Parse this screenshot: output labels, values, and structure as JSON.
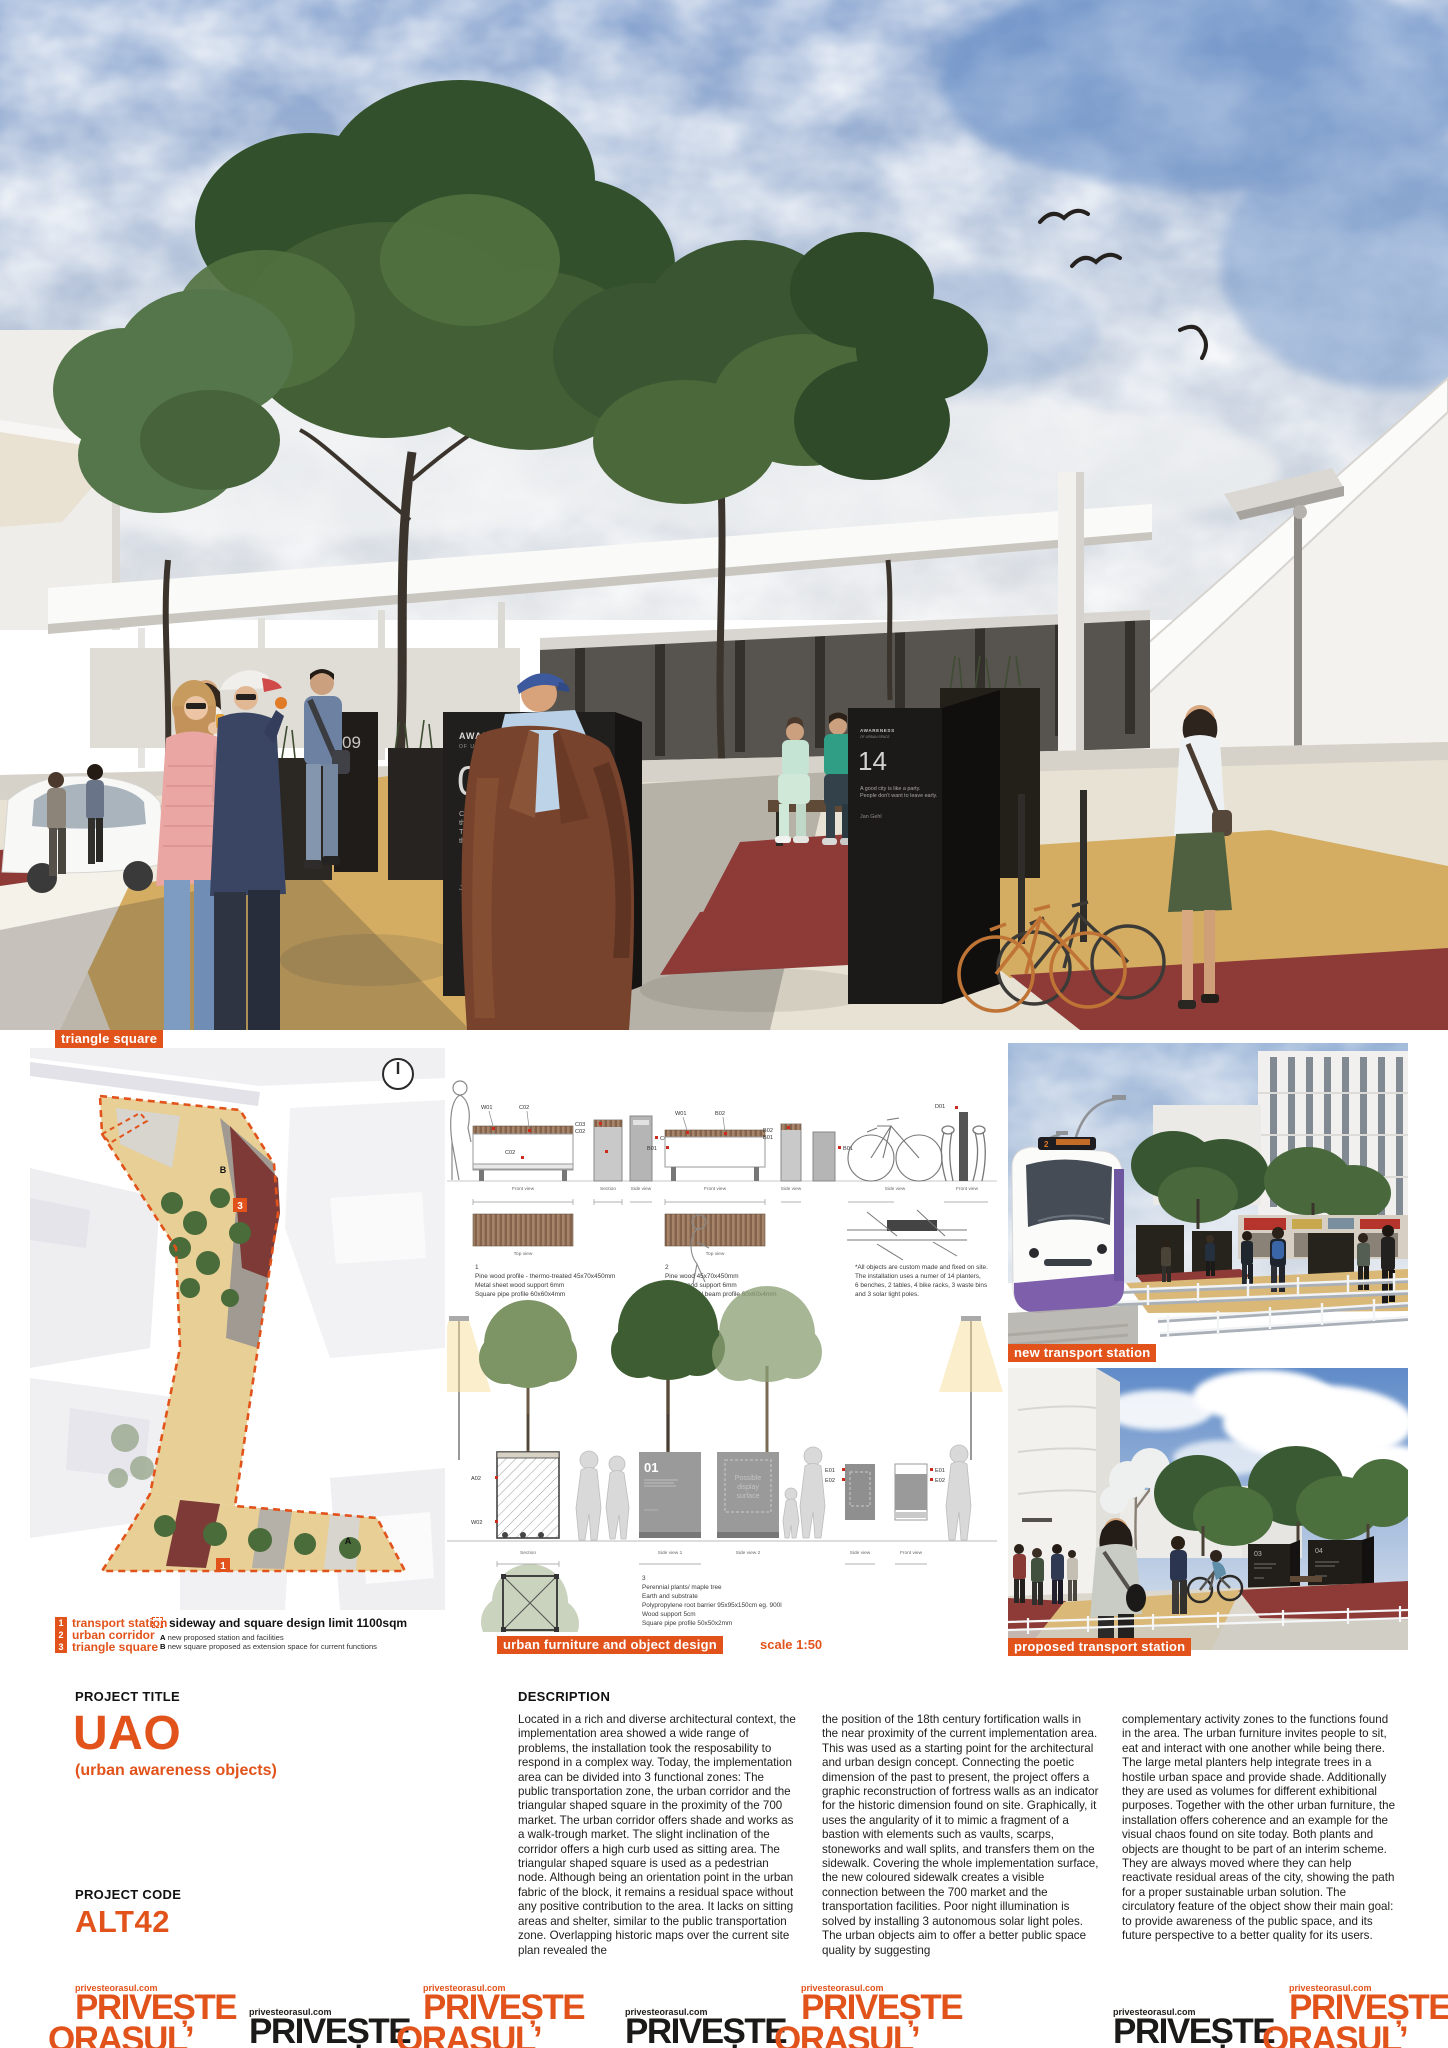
{
  "colors": {
    "accent": "#e2531c",
    "kiosk_dark": "#211e1b",
    "red_floor": "#8e3b38",
    "tan_floor": "#d4ad62"
  },
  "hero": {
    "kiosk08": {
      "header": "AWARENESS",
      "subheader": "OF URBAN SPACE",
      "number": "08",
      "quote_lines": [
        "Cultures and climates differ all over",
        "the world, but people are the same.",
        "They'll gather in public if you give",
        "them a good place to do it."
      ],
      "author": "Jan Gehl"
    },
    "kiosk14": {
      "header": "AWARENESS",
      "subheader": "OF URBAN SPACE",
      "number": "14",
      "quote_lines": [
        "A good city is like a party.",
        "People don't want to leave early."
      ],
      "author": "Jan Gehl"
    },
    "kiosk09_number": "09"
  },
  "site_plan": {
    "tag": "triangle square",
    "markers": {
      "one": "1",
      "three": "3",
      "a": "A",
      "b": "B"
    },
    "legend": {
      "zones": [
        {
          "num": "1",
          "label": "transport station"
        },
        {
          "num": "2",
          "label": "urban corridor"
        },
        {
          "num": "3",
          "label": "triangle square"
        }
      ],
      "limit_label": "sideway and square design limit 1100sqm",
      "notes": [
        {
          "key": "A",
          "text": "new proposed station and facilities"
        },
        {
          "key": "B",
          "text": "new square proposed as extension space for current functions"
        }
      ]
    }
  },
  "furniture": {
    "tag": "urban furniture and object design",
    "scale_label": "scale 1:50",
    "views": {
      "front": "Front view",
      "section": "Section",
      "side": "Side view",
      "top": "Top view",
      "side1": "Side view 1",
      "side2": "Side view 2"
    },
    "codes": {
      "w01": "W01",
      "c01": "C01",
      "c02": "C02",
      "c03": "C03",
      "b01": "B01",
      "b02": "B02",
      "d01": "D01",
      "a02": "A02",
      "w02": "W02",
      "e01": "E01",
      "e02": "E02"
    },
    "item1_lines": [
      "1",
      "Pine wood profile - thermo-treated 45x70x450mm",
      "Metal sheet wood support 6mm",
      "Square pipe profile 60x60x4mm"
    ],
    "item2_lines": [
      "2",
      "Pine wood 45x70x450mm",
      "Metal wood support 6mm",
      "Square metal beam profile 60x60x4mm"
    ],
    "item3_lines": [
      "3",
      "Perennial plants/ maple tree",
      "Earth and substrate",
      "Polypropylene root barrier 95x95x150cm eg. 900l",
      "Wood support 5cm",
      "Square pipe profile 50x50x2mm"
    ],
    "note_lines": [
      "*All objects are custom made and fixed on site.",
      "The installation uses a numer of 14 planters,",
      "6 benches, 2 tables, 4 bike racks, 3 waste bins",
      "and 3 solar light poles."
    ],
    "display_box": {
      "number": "01",
      "surface_l1": "Possible",
      "surface_l2": "display",
      "surface_l3": "surface"
    }
  },
  "right_renders": {
    "top_tag": "new transport station",
    "bottom_tag": "proposed transport station",
    "kiosk03": "03",
    "kiosk04": "04",
    "tram_route": "2"
  },
  "project": {
    "title_label": "PROJECT TITLE",
    "title": "UAO",
    "subtitle": "(urban awareness objects)",
    "code_label": "PROJECT CODE",
    "code": "ALT42"
  },
  "description": {
    "label": "DESCRIPTION",
    "col1": "Located in a rich and diverse architectural context, the implementation area showed a wide range of problems, the installation took the resposability to respond in a complex way. Today, the implementation area can be divided into 3 functional zones: The public transportation zone, the urban corridor and the triangular shaped square in the proximity of the 700 market. The urban corridor offers shade and works as a walk-trough market. The slight inclination of the corridor offers a high curb used as sitting area. The triangular shaped square is used as a pedestrian node. Although being an orientation point in the urban fabric of the block, it remains a residual space without any positive contribution to the area. It lacks on sitting areas and shelter, similar to the public transportation zone. Overlapping historic maps over the current site plan revealed the",
    "col2": "the position of the 18th century fortification walls in the near proximity of the current implementation area. This was used as a starting point for the architectural and urban design concept. Connecting the poetic dimension of the past to present, the project offers a graphic reconstruction of fortress walls as an indicator for the historic dimension found on site. Graphically, it uses the angularity of it to mimic a fragment of a bastion with elements such as vaults, scarps, stoneworks and wall splits, and transfers them on the sidewalk. Covering the whole implementation surface, the new coloured sidewalk creates a visible connection between the 700 market and the transportation facilities. Poor night illumination is solved by installing 3 autonomous solar light poles. The urban objects aim to offer a better public space quality by suggesting",
    "col3": "complementary activity zones to the functions found in the area. The urban furniture invites people to sit, eat and interact with one another while being there. The large metal planters help integrate trees in a hostile urban space and provide shade. Additionally they are used as volumes for different exhibitional purposes. Together with the other urban furniture, the installation offers coherence and an example for the visual chaos found on site today. Both plants and objects are thought to be part of an interim scheme. They are always moved where they can help reactivate residual areas of the city, showing the path for a proper sustainable urban solution. The circulatory feature of the object show their main goal: to provide awareness of the public space, and its future perspective to a better quality for its users."
  },
  "footer": {
    "url": "privesteorasul.com",
    "line1": "PRIVEȘTE",
    "line2": "ORAȘUL’"
  }
}
